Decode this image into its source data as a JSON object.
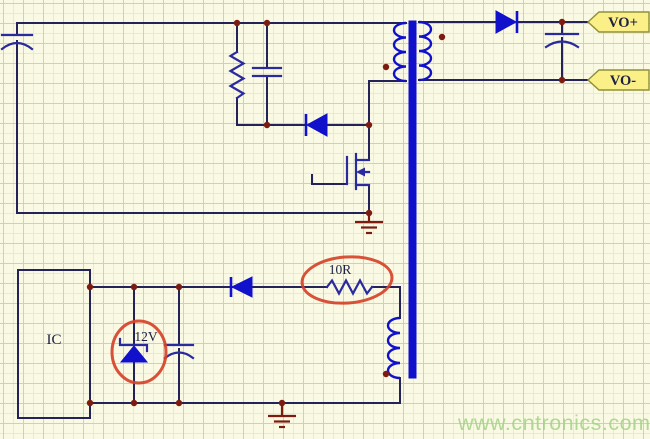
{
  "diagram": {
    "type": "flyback-converter-schematic",
    "labels": {
      "output_positive": "VO+",
      "output_negative": "VO-",
      "ic": "IC",
      "zener_voltage": "12V",
      "resistor_value": "10R"
    },
    "watermark": "www.cntronics.com",
    "components": [
      "input-capacitor",
      "snubber-resistor",
      "snubber-capacitor",
      "snubber-diode",
      "transformer-primary-winding",
      "transformer-core",
      "transformer-secondary-winding",
      "output-rectifier-diode",
      "output-capacitor",
      "mosfet",
      "power-ground",
      "ic-block",
      "zener-diode-12v",
      "vcc-capacitor",
      "vcc-diode",
      "resistor-10r",
      "transformer-aux-winding",
      "signal-ground"
    ],
    "annotations": [
      {
        "target": "zener-diode",
        "label": "12V",
        "style": "red-circle"
      },
      {
        "target": "resistor",
        "label": "10R",
        "style": "red-circle"
      }
    ],
    "colors": {
      "background": "#fafae4",
      "grid_minor": "#e9e9d6",
      "grid_major": "#cfcfba",
      "wire": "#23235a",
      "symbol": "#2a2a9e",
      "device_blue": "#1111cc",
      "junction": "#7c1c10",
      "ground": "#7c1c10",
      "highlight_red": "#d5422a",
      "tag_fill": "#faf087",
      "tag_border": "#8f8f38",
      "label_text": "#202045",
      "watermark_green": "#a5d289"
    }
  }
}
